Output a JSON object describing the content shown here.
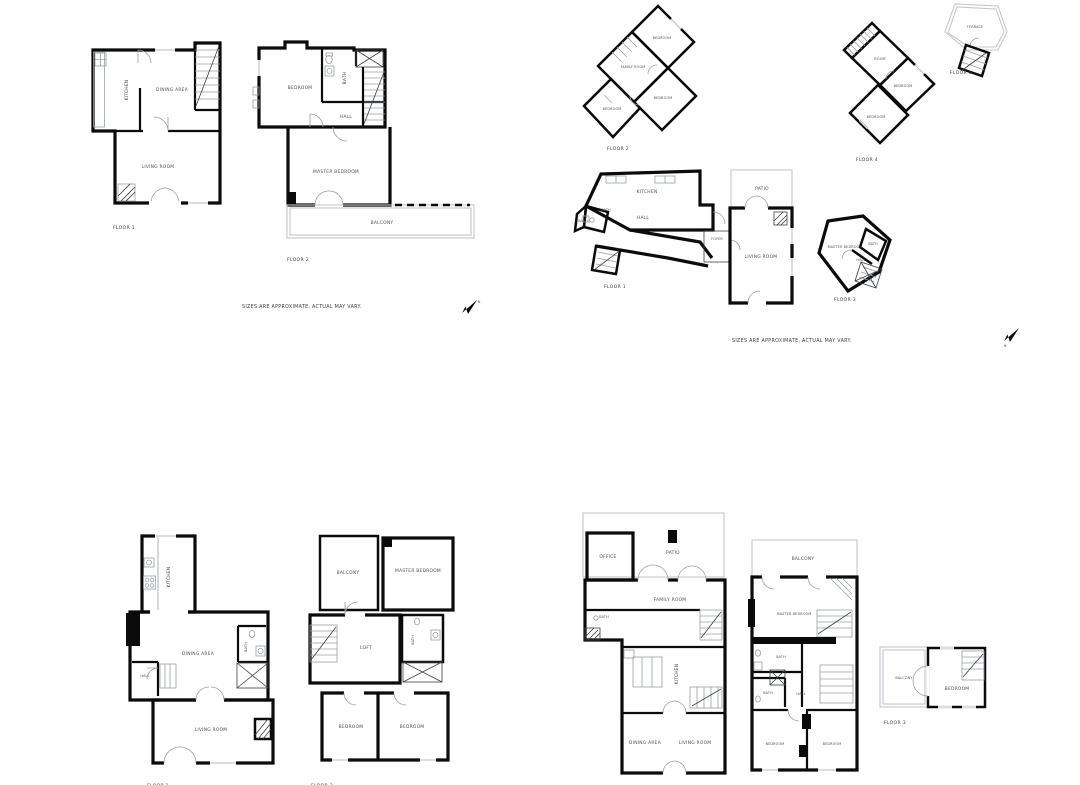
{
  "meta": {
    "disclaimer": "SIZES ARE APPROXIMATE, ACTUAL MAY VARY.",
    "north_label": "N"
  },
  "plans": {
    "tl_f1": {
      "floor": "FLOOR 1",
      "rooms": {
        "kitchen": "KITCHEN",
        "dining": "DINING AREA",
        "living": "LIVING ROOM"
      }
    },
    "tl_f2": {
      "floor": "FLOOR 2",
      "rooms": {
        "bedroom": "BEDROOM",
        "bath": "BATH",
        "hall": "HALL",
        "master": "MASTER BEDROOM",
        "balcony": "BALCONY"
      }
    },
    "tr_f2": {
      "floor": "FLOOR 2",
      "rooms": {
        "bedroom_top": "BEDROOM",
        "family": "FAMILY ROOM",
        "bedroom_right": "BEDROOM",
        "bedroom_bl": "BEDROOM"
      }
    },
    "tr_f4": {
      "floor": "FLOOR 4",
      "rooms": {
        "room": "ROOM",
        "bedroom_mid": "BEDROOM",
        "bedroom_bot": "BEDROOM"
      }
    },
    "tr_f5": {
      "floor": "FLOOR 5",
      "rooms": {
        "terrace": "TERRACE"
      }
    },
    "tr_f1": {
      "floor": "FLOOR 1",
      "rooms": {
        "kitchen": "KITCHEN",
        "hall": "HALL",
        "bath_a": "BATH",
        "bath_b": "BATH",
        "foyer": "FOYER",
        "patio": "PATIO",
        "living": "LIVING ROOM"
      }
    },
    "tr_f3": {
      "floor": "FLOOR 3",
      "rooms": {
        "master": "MASTER BEDROOM",
        "bath": "BATH",
        "hall": "HALL"
      }
    },
    "bl_f1": {
      "floor": "FLOOR 1",
      "rooms": {
        "kitchen": "KITCHEN",
        "dining": "DINING AREA",
        "bath": "BATH",
        "hall": "HALL",
        "living": "LIVING ROOM"
      }
    },
    "bl_f2": {
      "floor": "FLOOR 2",
      "rooms": {
        "balcony": "BALCONY",
        "master": "MASTER BEDROOM",
        "loft": "LOFT",
        "bath": "BATH",
        "bedroom_l": "BEDROOM",
        "bedroom_r": "BEDROOM"
      }
    },
    "br_f1": {
      "floor": "FLOOR 1",
      "rooms": {
        "office": "OFFICE",
        "patio": "PATIO",
        "family": "FAMILY ROOM",
        "bath": "BATH",
        "kitchen": "KITCHEN",
        "dining": "DINING AREA",
        "living": "LIVING ROOM"
      }
    },
    "br_f2": {
      "floor": "FLOOR 2",
      "rooms": {
        "balcony": "BALCONY",
        "master": "MASTER BEDROOM",
        "bath_a": "BATH",
        "bath_b": "BATH",
        "hall": "HALL",
        "bedroom_l": "BEDROOM",
        "bedroom_r": "BEDROOM"
      }
    },
    "br_f3": {
      "floor": "FLOOR 3",
      "rooms": {
        "balcony": "BALCONY",
        "bedroom": "BEDROOM"
      }
    }
  }
}
